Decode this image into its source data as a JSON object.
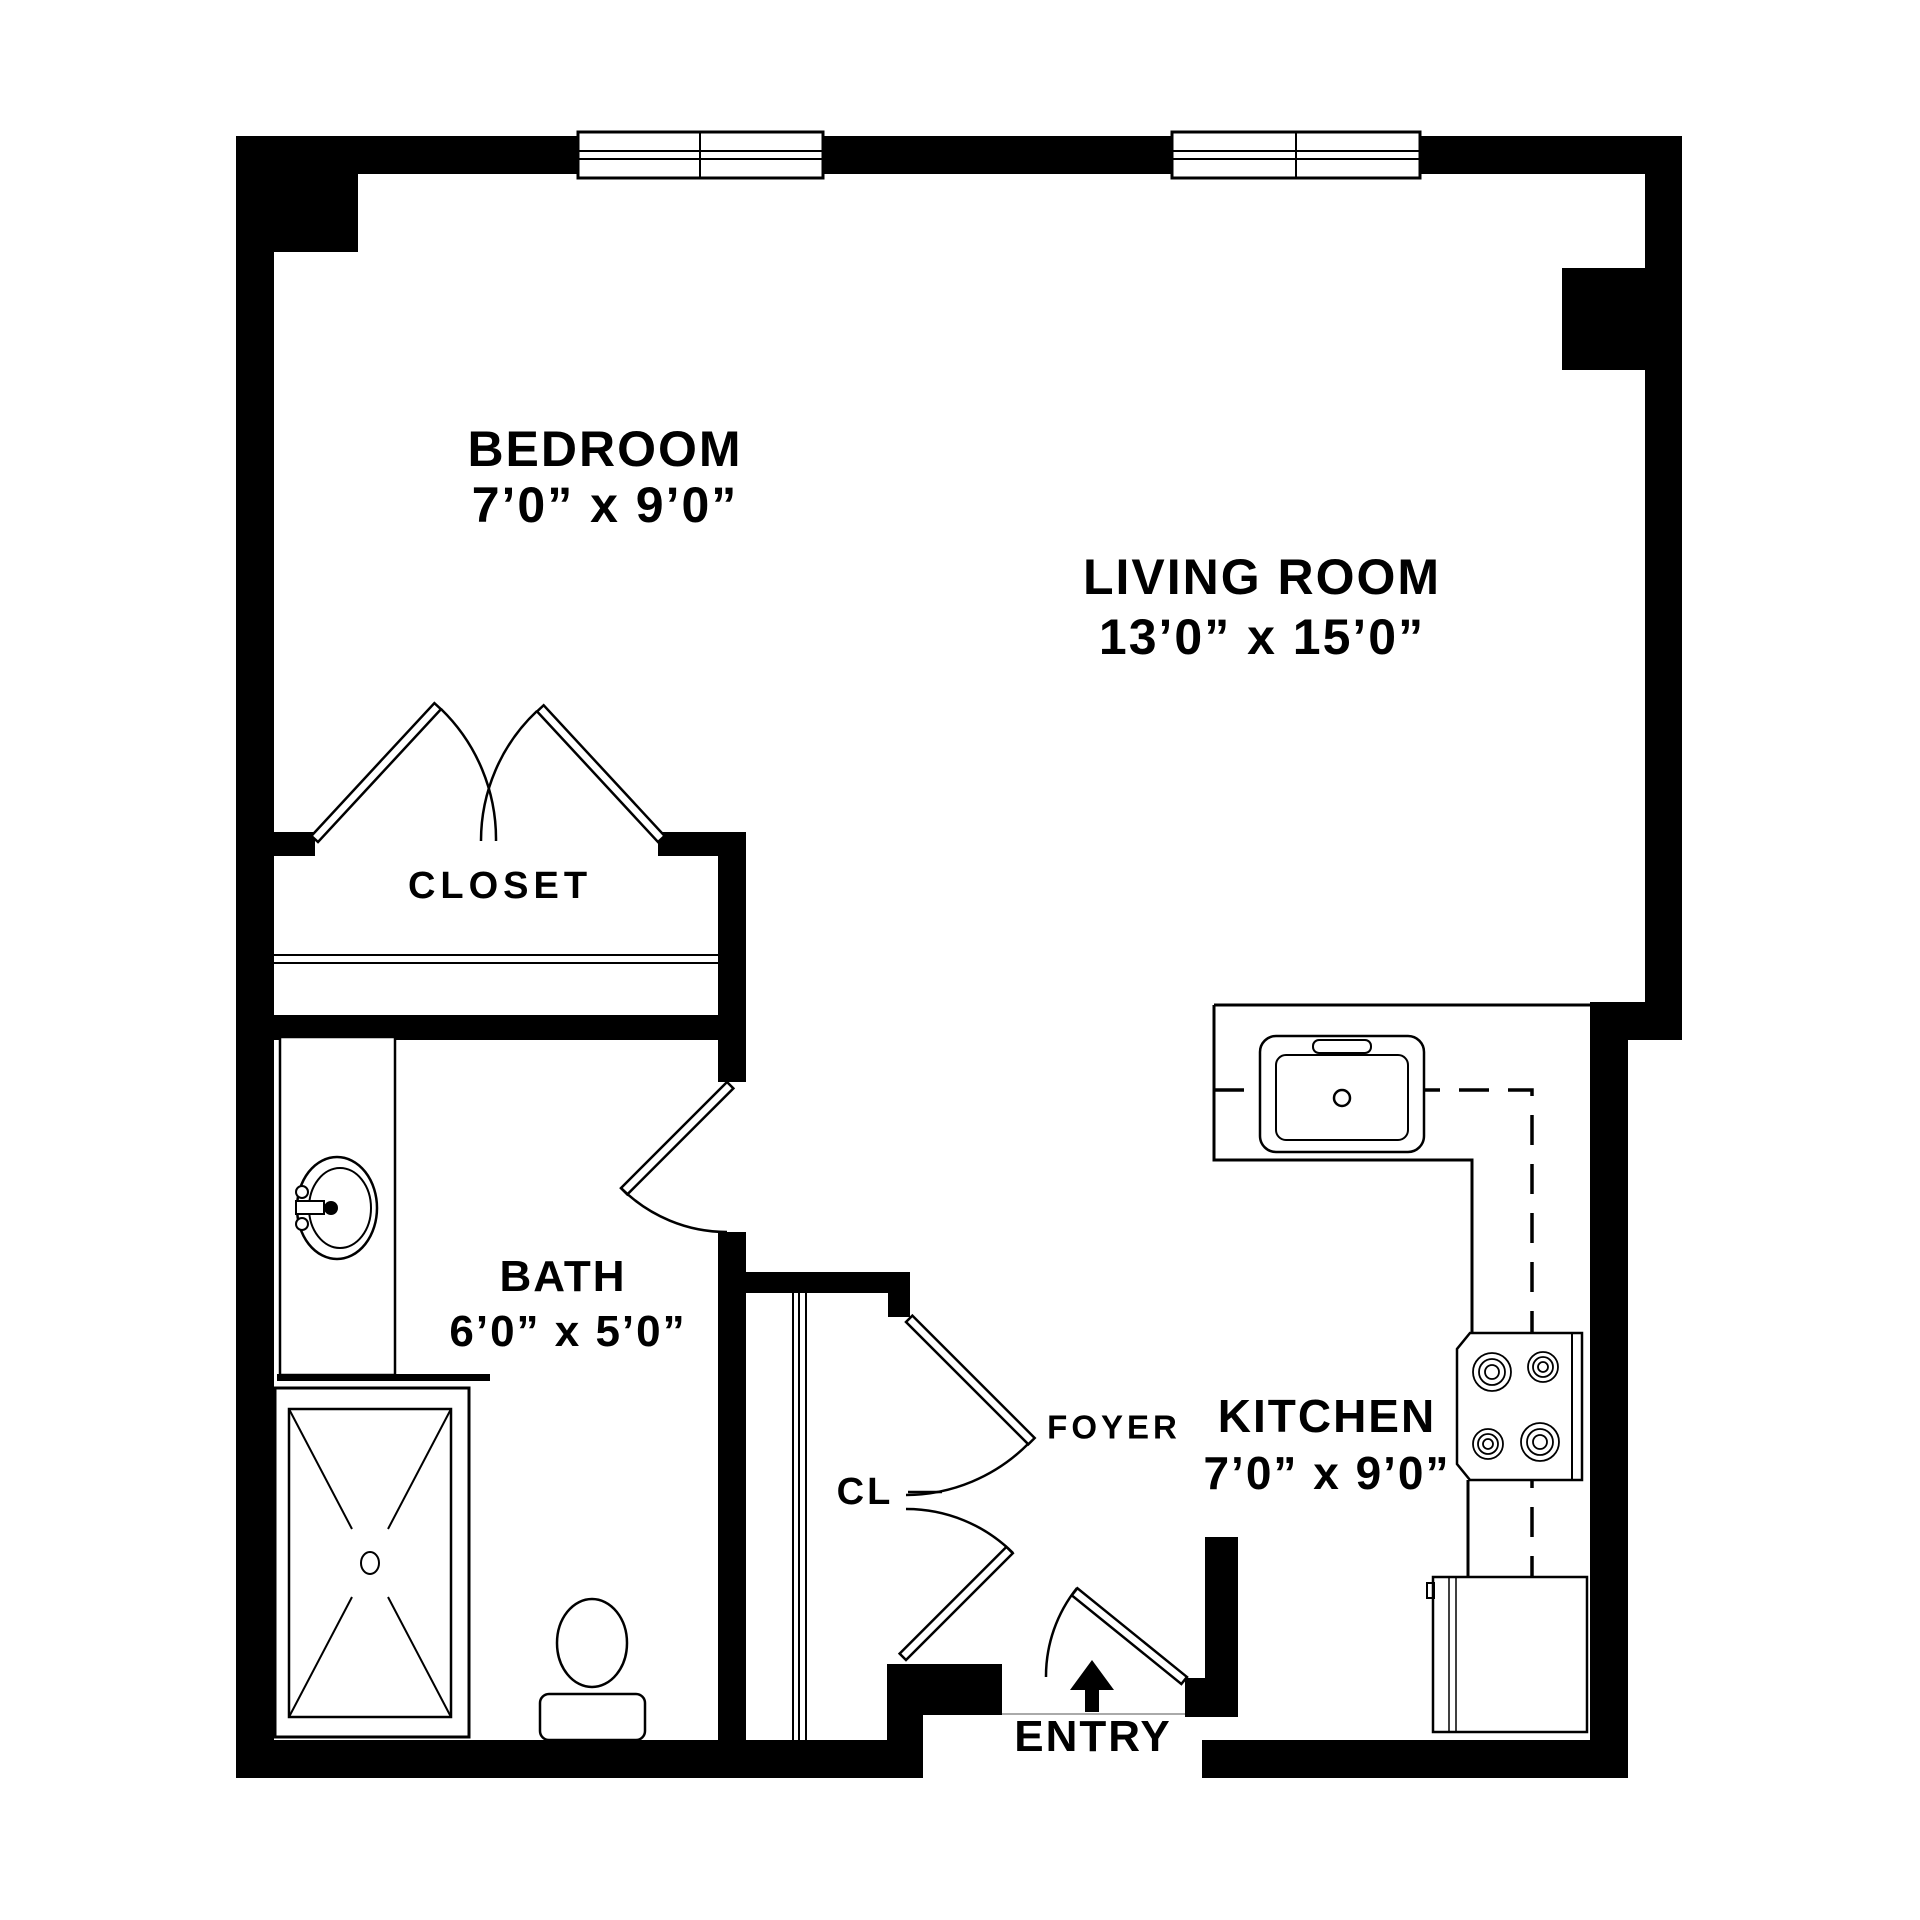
{
  "page": {
    "background": "#ffffff",
    "ink": "#000000"
  },
  "rooms": {
    "bedroom": {
      "label": "BEDROOM",
      "dims": "7’0” x 9’0”"
    },
    "living_room": {
      "label": "LIVING ROOM",
      "dims": "13’0” x 15’0”"
    },
    "closet": {
      "label": "CLOSET"
    },
    "bath": {
      "label": "BATH",
      "dims": "6’0” x 5’0”"
    },
    "foyer": {
      "label": "FOYER"
    },
    "foyer_closet": {
      "label": "CL"
    },
    "kitchen": {
      "label": "KITCHEN",
      "dims": "7’0” x 9’0”"
    },
    "entry": {
      "label": "ENTRY"
    }
  },
  "fixtures": [
    "window",
    "double-closet-doors",
    "swing-door",
    "bathroom-sink",
    "vanity",
    "shower",
    "toilet",
    "kitchen-counter",
    "kitchen-sink",
    "stove",
    "refrigerator",
    "upper-cabinets-dashed",
    "entry-arrow"
  ]
}
